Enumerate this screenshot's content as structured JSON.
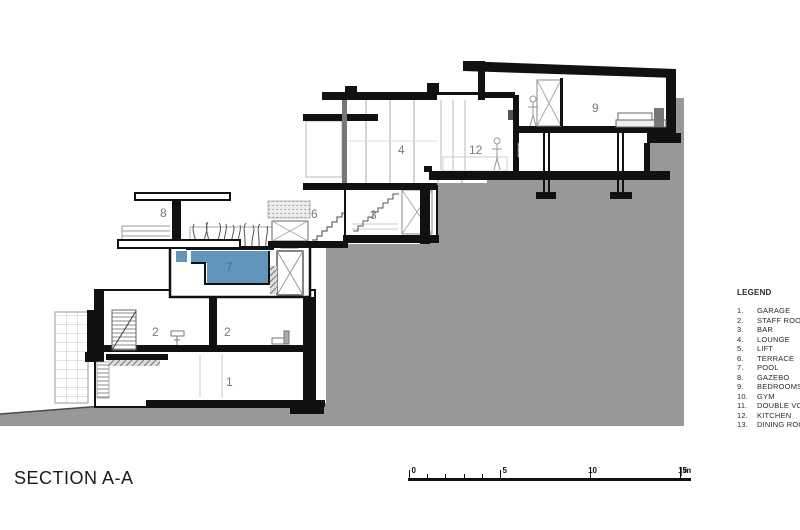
{
  "title": "SECTION A-A",
  "legend": {
    "heading": "LEGEND",
    "items": [
      {
        "num": "1.",
        "label": "GARAGE"
      },
      {
        "num": "2.",
        "label": "STAFF ROOM"
      },
      {
        "num": "3.",
        "label": "BAR"
      },
      {
        "num": "4.",
        "label": "LOUNGE"
      },
      {
        "num": "5.",
        "label": "LIFT"
      },
      {
        "num": "6.",
        "label": "TERRACE"
      },
      {
        "num": "7.",
        "label": "POOL"
      },
      {
        "num": "8.",
        "label": "GAZEBO"
      },
      {
        "num": "9.",
        "label": "BEDROOMS"
      },
      {
        "num": "10.",
        "label": "GYM"
      },
      {
        "num": "11.",
        "label": "DOUBLE VOLUME"
      },
      {
        "num": "12.",
        "label": "KITCHEN"
      },
      {
        "num": "13.",
        "label": "DINING ROOM"
      }
    ]
  },
  "scale_bar": {
    "labels": [
      "0",
      "5",
      "10",
      "15"
    ],
    "unit": "m"
  },
  "drawing": {
    "label_color": "#7a7a7a",
    "room_labels": [
      {
        "text": "8",
        "x": 160,
        "y": 217
      },
      {
        "text": "7",
        "x": 226,
        "y": 271,
        "color": "#46719a"
      },
      {
        "text": "6",
        "x": 311,
        "y": 218
      },
      {
        "text": "3",
        "x": 370,
        "y": 219
      },
      {
        "text": "4",
        "x": 398,
        "y": 154
      },
      {
        "text": "12",
        "x": 469,
        "y": 154
      },
      {
        "text": "9",
        "x": 592,
        "y": 112
      },
      {
        "text": "2",
        "x": 152,
        "y": 336
      },
      {
        "text": "2",
        "x": 224,
        "y": 336
      },
      {
        "text": "1",
        "x": 226,
        "y": 386
      }
    ],
    "colors": {
      "hillside": "#989898",
      "pool_water": "#6295bb",
      "ink": "#111111"
    }
  }
}
